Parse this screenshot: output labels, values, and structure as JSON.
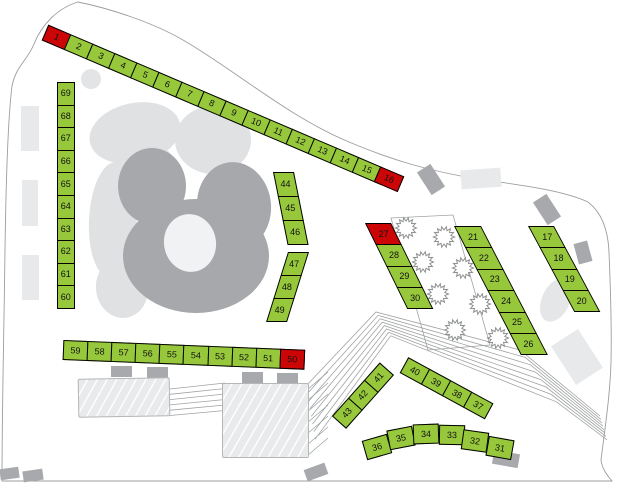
{
  "map": {
    "stall_colors": {
      "g": "#97c83c",
      "r": "#cc0606",
      "border": "#000000"
    },
    "groups": [
      {
        "id": "top-row",
        "stalls": [
          {
            "n": "1",
            "c": "r"
          },
          {
            "n": "2",
            "c": "g"
          },
          {
            "n": "3",
            "c": "g"
          },
          {
            "n": "4",
            "c": "g"
          },
          {
            "n": "5",
            "c": "g"
          },
          {
            "n": "6",
            "c": "g"
          },
          {
            "n": "7",
            "c": "g"
          },
          {
            "n": "8",
            "c": "g"
          },
          {
            "n": "9",
            "c": "g"
          },
          {
            "n": "10",
            "c": "g"
          },
          {
            "n": "11",
            "c": "g"
          },
          {
            "n": "12",
            "c": "g"
          },
          {
            "n": "13",
            "c": "g"
          },
          {
            "n": "14",
            "c": "g"
          },
          {
            "n": "15",
            "c": "g"
          },
          {
            "n": "16",
            "c": "r"
          }
        ]
      },
      {
        "id": "left-col",
        "stalls": [
          {
            "n": "69",
            "c": "g"
          },
          {
            "n": "68",
            "c": "g"
          },
          {
            "n": "67",
            "c": "g"
          },
          {
            "n": "66",
            "c": "g"
          },
          {
            "n": "65",
            "c": "g"
          },
          {
            "n": "64",
            "c": "g"
          },
          {
            "n": "63",
            "c": "g"
          },
          {
            "n": "62",
            "c": "g"
          },
          {
            "n": "61",
            "c": "g"
          },
          {
            "n": "60",
            "c": "g"
          }
        ]
      },
      {
        "id": "mid-row",
        "stalls": [
          {
            "n": "59",
            "c": "g"
          },
          {
            "n": "58",
            "c": "g"
          },
          {
            "n": "57",
            "c": "g"
          },
          {
            "n": "56",
            "c": "g"
          },
          {
            "n": "55",
            "c": "g"
          },
          {
            "n": "54",
            "c": "g"
          },
          {
            "n": "53",
            "c": "g"
          },
          {
            "n": "52",
            "c": "g"
          },
          {
            "n": "51",
            "c": "g"
          },
          {
            "n": "50",
            "c": "r"
          }
        ]
      },
      {
        "id": "arc-a",
        "stalls": [
          {
            "n": "44",
            "c": "g"
          },
          {
            "n": "45",
            "c": "g"
          },
          {
            "n": "46",
            "c": "g"
          }
        ]
      },
      {
        "id": "arc-b",
        "stalls": [
          {
            "n": "47",
            "c": "g"
          },
          {
            "n": "48",
            "c": "g"
          },
          {
            "n": "49",
            "c": "g"
          }
        ]
      },
      {
        "id": "col-27",
        "stalls": [
          {
            "n": "27",
            "c": "r"
          },
          {
            "n": "28",
            "c": "g"
          },
          {
            "n": "29",
            "c": "g"
          },
          {
            "n": "30",
            "c": "g"
          }
        ]
      },
      {
        "id": "col-21",
        "stalls": [
          {
            "n": "21",
            "c": "g"
          },
          {
            "n": "22",
            "c": "g"
          },
          {
            "n": "23",
            "c": "g"
          },
          {
            "n": "24",
            "c": "g"
          },
          {
            "n": "25",
            "c": "g"
          },
          {
            "n": "26",
            "c": "g"
          }
        ]
      },
      {
        "id": "col-17",
        "stalls": [
          {
            "n": "17",
            "c": "g"
          },
          {
            "n": "18",
            "c": "g"
          },
          {
            "n": "19",
            "c": "g"
          },
          {
            "n": "20",
            "c": "g"
          }
        ]
      },
      {
        "id": "row-43",
        "stalls": [
          {
            "n": "43",
            "c": "g"
          },
          {
            "n": "42",
            "c": "g"
          },
          {
            "n": "41",
            "c": "g"
          }
        ]
      },
      {
        "id": "row-40",
        "stalls": [
          {
            "n": "40",
            "c": "g"
          },
          {
            "n": "39",
            "c": "g"
          },
          {
            "n": "38",
            "c": "g"
          },
          {
            "n": "37",
            "c": "g"
          }
        ]
      },
      {
        "id": "bottom-arc",
        "stalls": [
          {
            "n": "36",
            "c": "g"
          },
          {
            "n": "35",
            "c": "g"
          },
          {
            "n": "34",
            "c": "g"
          },
          {
            "n": "33",
            "c": "g"
          },
          {
            "n": "32",
            "c": "g"
          },
          {
            "n": "31",
            "c": "g"
          }
        ]
      }
    ]
  }
}
